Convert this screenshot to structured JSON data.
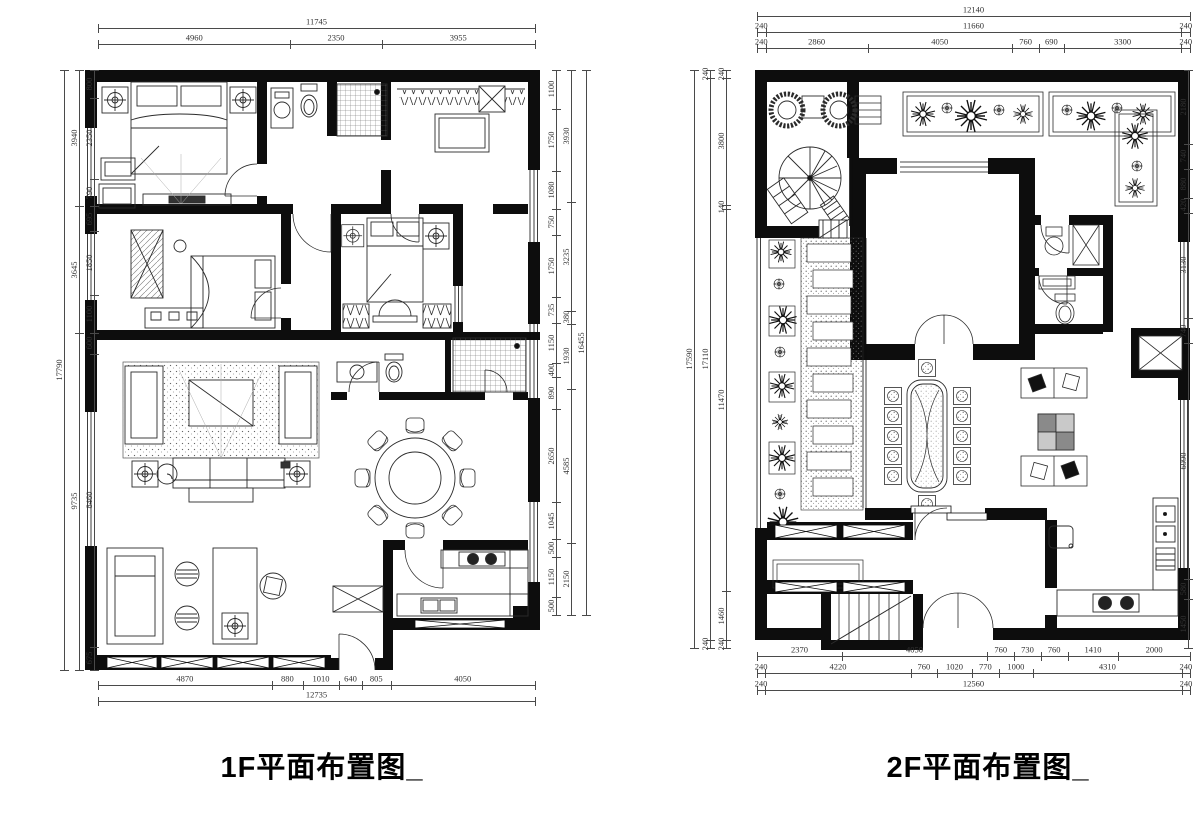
{
  "colors": {
    "walls": "#0d0d0d",
    "lines": "#2b2b2b",
    "dimensions": "#4a4a4a",
    "background": "#ffffff",
    "title": "#000000"
  },
  "plans": [
    {
      "id": "1F",
      "title": "1F平面布置图_"
    },
    {
      "id": "2F",
      "title": "2F平面布置图_"
    }
  ],
  "dimension_strips": [
    {
      "plan": "1F",
      "side": "top",
      "orient": "h",
      "x": 98,
      "y": 28,
      "length": 437,
      "row_gap": 16,
      "rows": [
        [
          "11745"
        ],
        [
          "4960",
          "2350",
          "3955"
        ]
      ]
    },
    {
      "plan": "1F",
      "side": "left",
      "orient": "v",
      "x": 64,
      "y": 70,
      "length": 600,
      "row_gap": 15,
      "rows": [
        [
          "17790"
        ],
        [
          "3940",
          "3645",
          "9735"
        ],
        [
          "800",
          "2350",
          "790",
          "695",
          "1850",
          "1100",
          "600",
          "8460",
          "675"
        ]
      ]
    },
    {
      "plan": "1F",
      "side": "right",
      "orient": "v",
      "x": 556,
      "y": 70,
      "length": 545,
      "row_gap": 15,
      "rows": [
        [
          "1100",
          "1750",
          "1080",
          "750",
          "1750",
          "735",
          "1150",
          "400",
          "890",
          "2650",
          "1045",
          "500",
          "1150",
          "500"
        ],
        [
          "3930",
          "3235",
          "380",
          "1930",
          "4585",
          "2150"
        ],
        [
          "16455"
        ]
      ]
    },
    {
      "plan": "1F",
      "side": "bottom",
      "orient": "h",
      "x": 98,
      "y": 685,
      "length": 437,
      "row_gap": 16,
      "rows": [
        [
          "4870",
          "880",
          "1010",
          "640",
          "805",
          "4050"
        ],
        [
          "12735"
        ]
      ]
    },
    {
      "plan": "2F",
      "side": "top",
      "orient": "h",
      "x": 757,
      "y": 16,
      "length": 433,
      "row_gap": 16,
      "rows": [
        [
          "12140"
        ],
        [
          "240",
          "11660",
          "240"
        ],
        [
          "240",
          "2860",
          "4050",
          "760",
          "690",
          "3300",
          "240"
        ]
      ]
    },
    {
      "plan": "2F",
      "side": "left",
      "orient": "v",
      "x": 694,
      "y": 70,
      "length": 578,
      "row_gap": 16,
      "rows": [
        [
          "17590"
        ],
        [
          "240",
          "17110",
          "240"
        ],
        [
          "240",
          "3800",
          "140",
          "11470",
          "1460",
          "240"
        ]
      ]
    },
    {
      "plan": "2F",
      "side": "right",
      "orient": "v",
      "x": 1188,
      "y": 70,
      "length": 578,
      "row_gap": 16,
      "rows": [
        [
          "2180",
          "740",
          "880",
          "420",
          "3130",
          "740",
          "6990",
          "580",
          "1450"
        ]
      ]
    },
    {
      "plan": "2F",
      "side": "bottom",
      "orient": "h",
      "x": 757,
      "y": 656,
      "length": 433,
      "row_gap": 17,
      "rows": [
        [
          "2370",
          "4050",
          "760",
          "730",
          "760",
          "1410",
          "2000"
        ],
        [
          "240",
          "4220",
          "760",
          "1020",
          "770",
          "1000",
          "4310",
          "240"
        ],
        [
          "240",
          "12560",
          "240"
        ]
      ]
    }
  ]
}
